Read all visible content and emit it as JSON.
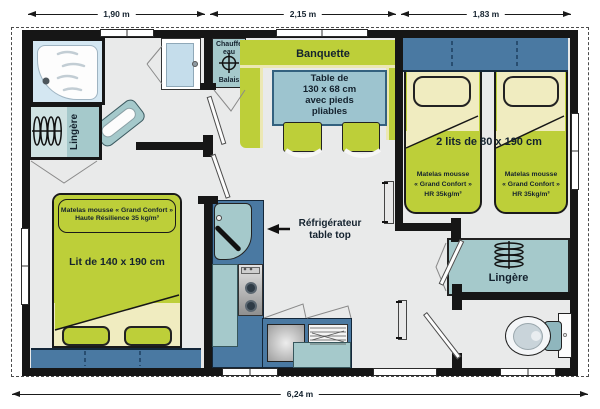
{
  "dimensions": {
    "top": [
      "1,90 m",
      "2,15 m",
      "1,83 m"
    ],
    "bottom": "6,24 m"
  },
  "bathroom": {
    "lingere": "Lingère"
  },
  "utility": {
    "line1": "Chauffe",
    "line2": "eau",
    "line3": "Balais"
  },
  "dining": {
    "banquette": "Banquette",
    "table_lines": [
      "Table de",
      "130 x 68 cm",
      "avec pieds",
      "pliables"
    ]
  },
  "kitchen": {
    "fridge_line1": "Réfrigérateur",
    "fridge_line2": "table top"
  },
  "twin_bedroom": {
    "title": "2 lits de 80 x 190 cm",
    "mattress": [
      "Matelas mousse",
      "« Grand Confort »",
      "HR 35kg/m³"
    ]
  },
  "master_bedroom": {
    "title": "Lit de 140 x 190 cm",
    "mattress": [
      "Matelas mousse « Grand Confort »",
      "Haute Résilience 35 kg/m³"
    ]
  },
  "storage": {
    "lingere": "Lingère"
  },
  "icons": {
    "water_heater_valve": "valve-cross-in-circle",
    "hangers_left": "clothes-hangers",
    "hangers_right": "clothes-hangers",
    "fridge_arrow": "left-arrow"
  },
  "colors": {
    "wall": "#161616",
    "floor": "#e9eaea",
    "green": "#bdcf39",
    "pale_yellow": "#f0ecc0",
    "teal": "#a5c9cb",
    "dark_blue": "#4a79a2",
    "table_blue": "#9dc4cf",
    "shower_blue": "#d4e7f2",
    "text": "#14222e"
  }
}
